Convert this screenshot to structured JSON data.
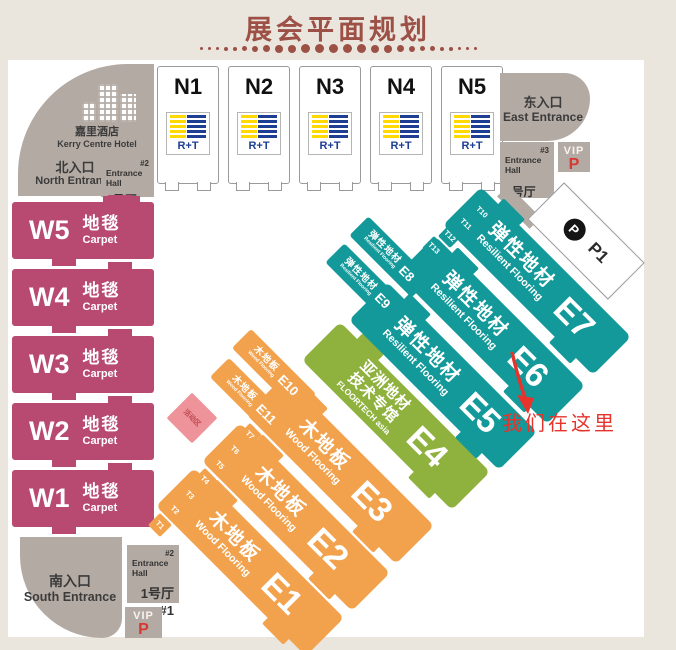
{
  "title": "展会平面规划",
  "hotel": {
    "cn": "嘉里酒店",
    "en": "Kerry Centre Hotel"
  },
  "entrances": {
    "north": {
      "cn": "北入口",
      "en": "North Entrance"
    },
    "east": {
      "cn": "东入口",
      "en": "East Entrance"
    },
    "south": {
      "cn": "南入口",
      "en": "South Entrance"
    }
  },
  "entrance_halls": {
    "north": {
      "tag": "#2",
      "label": "Entrance Hall",
      "name": "2号厅 #2"
    },
    "east": {
      "tag": "#3",
      "label": "Entrance Hall",
      "name": "3号厅 #3"
    },
    "south": {
      "tag": "#2",
      "label": "Entrance Hall",
      "name": "1号厅",
      "num": "#1"
    }
  },
  "vip": {
    "label": "VIP",
    "p": "P"
  },
  "parking": {
    "p": "P",
    "id": "P1"
  },
  "n_halls": [
    {
      "id": "N1",
      "logo": "R+T"
    },
    {
      "id": "N2",
      "logo": "R+T"
    },
    {
      "id": "N3",
      "logo": "R+T"
    },
    {
      "id": "N4",
      "logo": "R+T"
    },
    {
      "id": "N5",
      "logo": "R+T"
    }
  ],
  "w_halls": [
    {
      "id": "W5",
      "cn": "地毯",
      "en": "Carpet"
    },
    {
      "id": "W4",
      "cn": "地毯",
      "en": "Carpet"
    },
    {
      "id": "W3",
      "cn": "地毯",
      "en": "Carpet"
    },
    {
      "id": "W2",
      "cn": "地毯",
      "en": "Carpet"
    },
    {
      "id": "W1",
      "cn": "地毯",
      "en": "Carpet"
    }
  ],
  "e_halls": [
    {
      "id": "E1",
      "cn": "木地板",
      "en": "Wood Flooring"
    },
    {
      "id": "E2",
      "cn": "木地板",
      "en": "Wood Flooring"
    },
    {
      "id": "E3",
      "cn": "木地板",
      "en": "Wood Flooring"
    },
    {
      "id": "E4",
      "cn": "亚洲地材",
      "cn2": "技术专馆",
      "en": "FLOORTECH asia"
    },
    {
      "id": "E5",
      "cn": "弹性地材",
      "en": "Resilient Flooring"
    },
    {
      "id": "E6",
      "cn": "弹性地材",
      "en": "Resilient Flooring"
    },
    {
      "id": "E7",
      "cn": "弹性地材",
      "en": "Resilient Flooring"
    }
  ],
  "e_small": [
    {
      "id": "E8",
      "cn": "弹性地材",
      "en": "Resilient Flooring"
    },
    {
      "id": "E9",
      "cn": "弹性地材",
      "en": "Resilient Flooring"
    },
    {
      "id": "E10",
      "cn": "木地板",
      "en": "Wood Flooring"
    },
    {
      "id": "E11",
      "cn": "木地板",
      "en": "Wood Flooring"
    }
  ],
  "t_orange": [
    "T1",
    "T2",
    "T3",
    "T4",
    "T5",
    "T6",
    "T7"
  ],
  "t_teal": [
    "T13",
    "T12",
    "T11",
    "T10"
  ],
  "activity_area": "活动区",
  "marker": "我们在这里",
  "colors": {
    "carpet": "#b84a71",
    "wood": "#f2a24d",
    "resilient": "#13999a",
    "floortech": "#8fb13e",
    "gray": "#b3aaa3",
    "accent_red": "#e6332b",
    "title": "#9c5046",
    "rt_blue": "#1d3e92",
    "rt_yellow": "#ffd900"
  }
}
